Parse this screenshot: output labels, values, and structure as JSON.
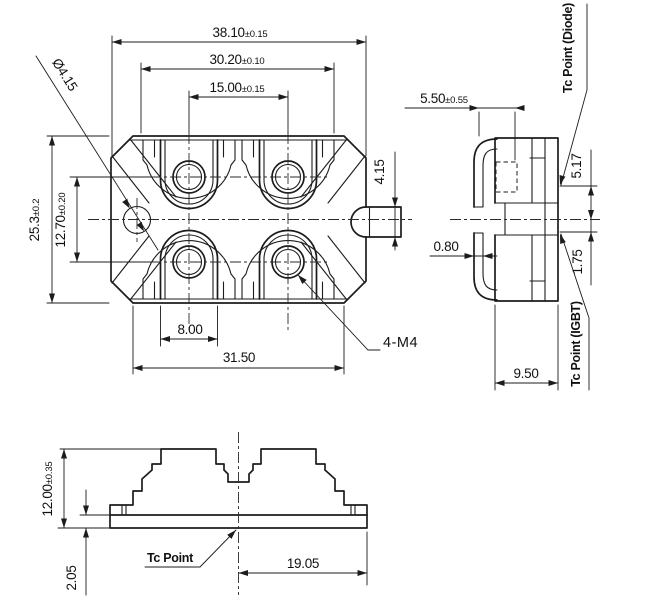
{
  "top_view": {
    "dim_overall_width": "38.10",
    "tol_overall_width": "±0.15",
    "dim_pad_span": "30.20",
    "tol_pad_span": "±0.10",
    "dim_hole_pitch_x": "15.00",
    "tol_hole_pitch_x": "±0.15",
    "dim_mount_hole_dia": "Ø4.15",
    "dim_overall_height": "25.3",
    "tol_overall_height": "±0.2",
    "dim_hole_pitch_y": "12.70",
    "tol_hole_pitch_y": "±0.20",
    "dim_tab_width": "4.15",
    "dim_pad_width": "8.00",
    "dim_body_width": "31.50",
    "label_thread": "4-M4"
  },
  "side_view": {
    "dim_lead_offset": "5.50",
    "tol_lead_offset": "±0.55",
    "dim_lead_thickness": "0.80",
    "label_tc_diode": "Tc Point (Diode)",
    "label_tc_igbt": "Tc Point (IGBT)",
    "dim_tc_diode_offset": "5.17",
    "dim_tc_igbt_offset": "1.75",
    "dim_body_depth": "9.50"
  },
  "front_view": {
    "dim_height": "12.00",
    "tol_height": "±0.35",
    "dim_base_thickness": "2.05",
    "label_tc_point": "Tc Point",
    "dim_half_width": "19.05"
  }
}
